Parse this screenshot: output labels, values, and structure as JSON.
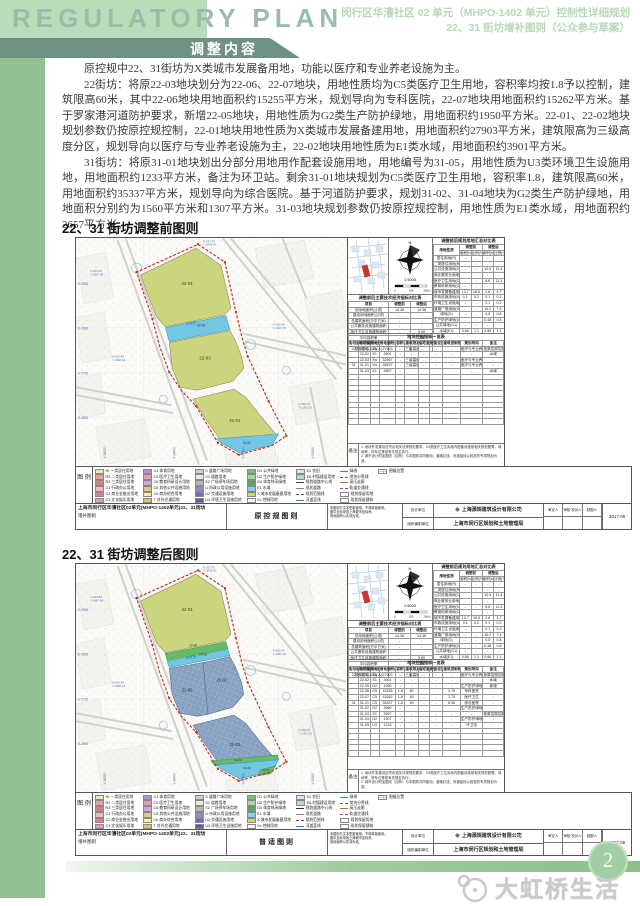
{
  "header": {
    "title_en": "REGULATORY PLAN",
    "banner": "调整内容",
    "right_line1": "闵行区华漕社区 02 单元（MHPO-1402 单元）控制性详细规划",
    "right_line2": "22、31 街坊增补图则（公众参与草案）"
  },
  "intro": {
    "p1": "原控规中22、31街坊为X类城市发展备用地，功能以医疗和专业养老设施为主。",
    "p2": "22街坊：将原22-03地块划分为22-06、22-07地块，用地性质均为C5类医疗卫生用地，容积率均按1.8予以控制，建筑限高60米，其中22-06地块用地面积约15255平方米，规划导向为专科医院，22-07地块用地面积约15262平方米。基于罗家港河道防护要求，新增22-05地块，用地性质为G2类生产防护绿地，用地面积约1950平方米。22-01、22-02地块规划参数仍按原控规控制，22-01地块用地性质为X类城市发展备建用地，用地面积约27903平方米，建筑限高为三级高度分区，规划导向以医疗与专业养老设施为主，22-02地块用地性质为E1类水域，用地面积约3901平方米。",
    "p3": "31街坊：将原31-01地块划出分部分用地用作配套设施用地，用地编号为31-05，用地性质为U3类环境卫生设施用地，用地面积约1233平方米，备注为环卫站。剩余31-01地块规划为C5类医疗卫生用地，容积率1.8，建筑限高60米，用地面积约35337平方米，规划导向为综合医院。基于河道防护要求，规划31-02、31-04地块为G2类生产防护绿地，用地面积分别约为1560平方米和1307平方米。31-03地块规划参数仍按原控规控制，用地性质为E1类水域，用地面积约2657平方米。"
  },
  "compass": {
    "scale_text": "1:5000",
    "scale_ticks": [
      "0",
      "100",
      "200m"
    ]
  },
  "map_common": {
    "river_label": "罗家港",
    "grid_left": [
      "E-2500",
      "E-2600",
      "E-2700",
      "E-2800"
    ],
    "grid_bottom": [
      "Y-18000",
      "Y-18400",
      "Y-18800",
      "Y-19200"
    ],
    "coords": [
      "X-203.50 Y-1467.68",
      "X-257.70 Y-1840.91",
      "X-553.98 Y-1462.76",
      "X-952.87 Y-1362.93",
      "X-255.50 Y-1398.62"
    ]
  },
  "tables": {
    "tableA_title": "调整前后规划用地汇总对比表",
    "tableA_h1": [
      "用地性质",
      "调整前",
      "调整后"
    ],
    "tableA_h2": [
      "面积(ha)",
      "比例(%)",
      "面积(ha)",
      "比例(%)"
    ],
    "tableA_rows": [
      [
        "居住用地(R)",
        "-",
        "-",
        "-",
        "-"
      ],
      [
        "二类居住用地(R2)",
        "-",
        "-",
        "-",
        "-"
      ],
      [
        "公共设施用地(C)",
        "-",
        "-",
        "10.5",
        "11.4"
      ],
      [
        "商业服务业用地(C2)",
        "-",
        "-",
        "-",
        "-"
      ],
      [
        "医疗卫生用地(C5)",
        "-",
        "-",
        "6.6",
        "11.3"
      ],
      [
        "教育科研用地(C6)",
        "-",
        "-",
        "-",
        "-"
      ],
      [
        "城市发展备建用地(X)",
        "13.7",
        "18.5",
        "2.8",
        "4.7"
      ],
      [
        "市政设施用地(U)",
        "0.1",
        "0.2",
        "0.1",
        "0.2"
      ],
      [
        "环境卫生设施用地(U3)",
        "-",
        "-",
        "0.1",
        "0.2"
      ],
      [
        "道路广场用地(S)",
        "-",
        "-",
        "10.2",
        "7.4"
      ],
      [
        "绿地(G)",
        "-",
        "-",
        "0.5",
        "0.8"
      ],
      [
        "生产防护绿地(G2)",
        "-",
        "-",
        "0.48",
        "0.8"
      ],
      [
        "公共绿地(G1)",
        "-",
        "-",
        "-",
        "-"
      ],
      [
        "水域(E1)",
        "0.66",
        "1.1",
        "0.66",
        "1.1"
      ],
      [
        "建设用地合计",
        "13.7",
        "60.1",
        "13.7",
        "60.1"
      ],
      [
        "总用地",
        "14.4",
        "100",
        "14.4",
        "100"
      ]
    ],
    "tableB_title": "调整前后主要技术经济指标对比表",
    "tableB_h": [
      "项目",
      "调整前",
      "调整后"
    ],
    "tableB_rows": [
      [
        "总用地面积(公顷)",
        "14.38",
        "14.38"
      ],
      [
        "建设用地面积(公顷)",
        "-",
        "-"
      ],
      [
        "总建筑面积(万平方米)",
        "-",
        "-"
      ],
      [
        "公共服务设施建筑面积",
        "-",
        "-"
      ],
      [
        "医疗卫生设施建筑面积",
        "-",
        "5.50"
      ],
      [
        "平均容积率",
        "-",
        "1.8"
      ],
      [
        "建筑限高(米)",
        "-",
        "60"
      ],
      [
        "规划居住人口(人)",
        "-",
        "-"
      ]
    ],
    "tableC_title": "地块控制指标一览表",
    "tableC_h": [
      "街坊编号",
      "地块编号",
      "用地性质",
      "用地面积(平方米)",
      "容积率",
      "建筑限高(米)",
      "住宅套数(套)",
      "配套设施",
      "建筑控制规模(万平方米)",
      "规划导向",
      "备注"
    ],
    "notes_label": "备注",
    "notes_lines": [
      "1. 地块开发建设应符合相关法规规范要求，C5类医疗卫生用地内配套设施按相关规范配置，绿地率、停车位等按有关规定执行。",
      "2. 城市设计附加图则（如有）与本图则共同使用；道路红线、河道蓝线以批准的专项规划为准。"
    ]
  },
  "figures": {
    "before": {
      "heading": "22、31 街坊调整前图则",
      "sheet_label": "原控规图则",
      "map_labels": [
        {
          "t": "22-01",
          "x": 112,
          "y": 47,
          "s": 4.5
        },
        {
          "t": "22-02",
          "x": 126,
          "y": 89,
          "s": 3.4
        },
        {
          "t": "22-03",
          "x": 130,
          "y": 122,
          "s": 4.5
        },
        {
          "t": "31-01",
          "x": 160,
          "y": 185,
          "s": 4.5
        },
        {
          "t": "31-03",
          "x": 172,
          "y": 207,
          "s": 3.2
        }
      ],
      "tableC_rows": [
        [
          "22",
          "22-01",
          "Xw",
          "27903",
          "-",
          "三级高度分区",
          "-",
          "-",
          "-",
          "医疗与专业养老设施",
          "按原控规控制"
        ],
        [
          "",
          "22-02",
          "E1",
          "3901",
          "-",
          "-",
          "-",
          "-",
          "-",
          "-",
          "水域"
        ],
        [
          "",
          "22-03",
          "Xw",
          "32467",
          "-",
          "三级高度分区",
          "-",
          "-",
          "-",
          "医疗与专业养老设施",
          "-"
        ],
        [
          "31",
          "31-01",
          "Xw",
          "39437",
          "-",
          "三级高度分区",
          "-",
          "-",
          "-",
          "医疗与专业养老设施",
          "-"
        ],
        [
          "",
          "31-03",
          "E1",
          "2657",
          "-",
          "-",
          "-",
          "-",
          "-",
          "-",
          "水域"
        ]
      ],
      "tableC_blank": 9
    },
    "after": {
      "heading": "22、31 街坊调整后图则",
      "sheet_label": "普适图则",
      "map_labels": [
        {
          "t": "22-01",
          "x": 112,
          "y": 47,
          "s": 4.5
        },
        {
          "t": "22-05",
          "x": 118,
          "y": 83,
          "s": 3.2
        },
        {
          "t": "22-02",
          "x": 128,
          "y": 92,
          "s": 3.2
        },
        {
          "t": "22-06",
          "x": 112,
          "y": 128,
          "s": 4.2
        },
        {
          "t": "22-07",
          "x": 147,
          "y": 118,
          "s": 4.2
        },
        {
          "t": "31-01",
          "x": 160,
          "y": 183,
          "s": 4.5
        },
        {
          "t": "31-02",
          "x": 163,
          "y": 198,
          "s": 3.0
        },
        {
          "t": "31-03",
          "x": 172,
          "y": 206,
          "s": 3.0
        },
        {
          "t": "31-04",
          "x": 191,
          "y": 208,
          "s": 3.0
        }
      ],
      "tableC_rows": [
        [
          "22",
          "22-01",
          "Xw",
          "27903",
          "-",
          "三级高度分区",
          "-",
          "-",
          "-",
          "医疗与专业养老设施",
          "按原控规控制"
        ],
        [
          "",
          "22-02",
          "E1",
          "3901",
          "-",
          "-",
          "-",
          "-",
          "-",
          "-",
          "水域"
        ],
        [
          "",
          "22-05",
          "G2",
          "1950",
          "-",
          "-",
          "-",
          "-",
          "-",
          "生产防护绿地",
          "新增"
        ],
        [
          "",
          "22-06",
          "C5",
          "15255",
          "1.8",
          "60",
          "-",
          "-",
          "2.75",
          "专科医院",
          "-"
        ],
        [
          "",
          "22-07",
          "C5",
          "15262",
          "1.8",
          "60",
          "-",
          "-",
          "2.75",
          "医疗卫生",
          "-"
        ],
        [
          "31",
          "31-01",
          "C5",
          "35337",
          "1.8",
          "60",
          "-",
          "-",
          "6.36",
          "综合医院",
          "-"
        ],
        [
          "",
          "31-02",
          "G2",
          "1560",
          "-",
          "-",
          "-",
          "-",
          "-",
          "生产防护绿地",
          "-"
        ],
        [
          "",
          "31-03",
          "E1",
          "2657",
          "-",
          "-",
          "-",
          "-",
          "-",
          "-",
          "按原控规控制"
        ],
        [
          "",
          "31-04",
          "G2",
          "1307",
          "-",
          "-",
          "-",
          "-",
          "-",
          "生产防护绿地",
          "-"
        ],
        [
          "",
          "31-05",
          "U3",
          "1233",
          "-",
          "-",
          "-",
          "-",
          "-",
          "环卫站",
          "-"
        ]
      ],
      "tableC_blank": 5
    }
  },
  "legend": {
    "label": "图 例",
    "items": [
      {
        "c": "#f2e6b3",
        "t": "Rr 一类居住用地"
      },
      {
        "c": "#e8a0a0",
        "t": "R2 二类居住用地"
      },
      {
        "c": "#d97f7f",
        "t": "R3 三类居住用地"
      },
      {
        "c": "#f0b9c9",
        "t": "C1 行政办公用地"
      },
      {
        "c": "#e2808f",
        "t": "C2 商业金融业用地"
      },
      {
        "c": "#d8a0c8",
        "t": "C3 文化娱乐用地"
      },
      {
        "c": "#b98fd0",
        "t": "C4 体育用地"
      },
      {
        "c": "#e89bb5",
        "t": "C5 医疗卫生用地"
      },
      {
        "c": "#cfa8e0",
        "t": "C6 教育科研设计用地"
      },
      {
        "c": "#e6c78a",
        "t": "C8 其他公共设施用地"
      },
      {
        "c": "#f5f0a0",
        "t": "Cb 商办综合用地"
      },
      {
        "c": "#d8c078",
        "t": "T 对外交通用地"
      },
      {
        "c": "#cfcfcf",
        "t": "S 道路广场用地"
      },
      {
        "c": "#e8e8e8",
        "t": "S1 道路用地"
      },
      {
        "c": "#b5b5b5",
        "t": "S2 广场停车场用地"
      },
      {
        "c": "#9a88c5",
        "t": "U 市政公用设施用地"
      },
      {
        "c": "#7a68b5",
        "t": "U2 交通设施用地"
      },
      {
        "c": "#6858a8",
        "t": "U3 环境卫生设施用地"
      },
      {
        "c": "#78c078",
        "t": "G1 公共绿地"
      },
      {
        "c": "#a8d8a0",
        "t": "G2 生产防护绿地"
      },
      {
        "c": "#58a858",
        "t": "G4 体育休闲绿地"
      },
      {
        "c": "#88d0e8",
        "t": "E1 水域"
      },
      {
        "c": "#c8d87a",
        "t": "X 城市发展备建用地"
      },
      {
        "c": "#f8f8f8",
        "t": "Xc 控制用地"
      },
      {
        "c": "#d0e8f0",
        "t": "E2 农田"
      },
      {
        "c": "#b8d8c8",
        "t": "E6 村镇建设用地"
      },
      {
        "line": "solid",
        "col": "#333333",
        "t": "规划道路中心线"
      },
      {
        "line": "solid",
        "col": "#888888",
        "t": "现状道路"
      },
      {
        "line": "dashed",
        "col": "#cc2222",
        "t": "规划范围线"
      },
      {
        "line": "solid",
        "col": "#2288cc",
        "t": "河道蓝线"
      },
      {
        "line": "solid",
        "col": "#22aa44",
        "t": "绿线"
      },
      {
        "line": "dashed",
        "col": "#666666",
        "t": "地块分界线"
      },
      {
        "line": "solid",
        "col": "#aa7722",
        "t": "高压走廊"
      },
      {
        "line": "dashed",
        "col": "#9944aa",
        "t": "轨道交通线"
      },
      {
        "box": true,
        "t": "规划保留用地"
      },
      {
        "box": true,
        "t": "现状保留建筑"
      },
      {
        "grid": true,
        "t": "图幅位置"
      }
    ]
  },
  "titleblock": {
    "project_line1": "上海市闵行区华漕社区02单元(MHPO-1402单元)22、31街坊",
    "project_line2": "增补图则",
    "note_lines": [
      "本图则与文本配套使用，不得单独使用。",
      "图中坐标采用上海城市坐标系。",
      "用地面积以实测为准。"
    ],
    "design_label": "设计单位",
    "design_value": "上海源规建筑设计有限公司",
    "org_label": "组织编制单位",
    "org_value": "上海市闵行区规划和土地管理局",
    "sign_headers": [
      "审定人",
      "审核·校对人",
      "制图人"
    ],
    "date": "2017.08"
  },
  "footer": {
    "page_number": "2",
    "watermark": "大虹桥生活网"
  },
  "colors": {
    "parcel_yellow": "#ccd57d",
    "parcel_slate": "#7e9abc",
    "water_blue": "#72c8e2",
    "green_strip": "#66bb66",
    "boundary_red": "#cc2222",
    "header_green": "#b9dcb9",
    "banner_green": "#6e9181",
    "sidebar_green": "#92c092"
  }
}
